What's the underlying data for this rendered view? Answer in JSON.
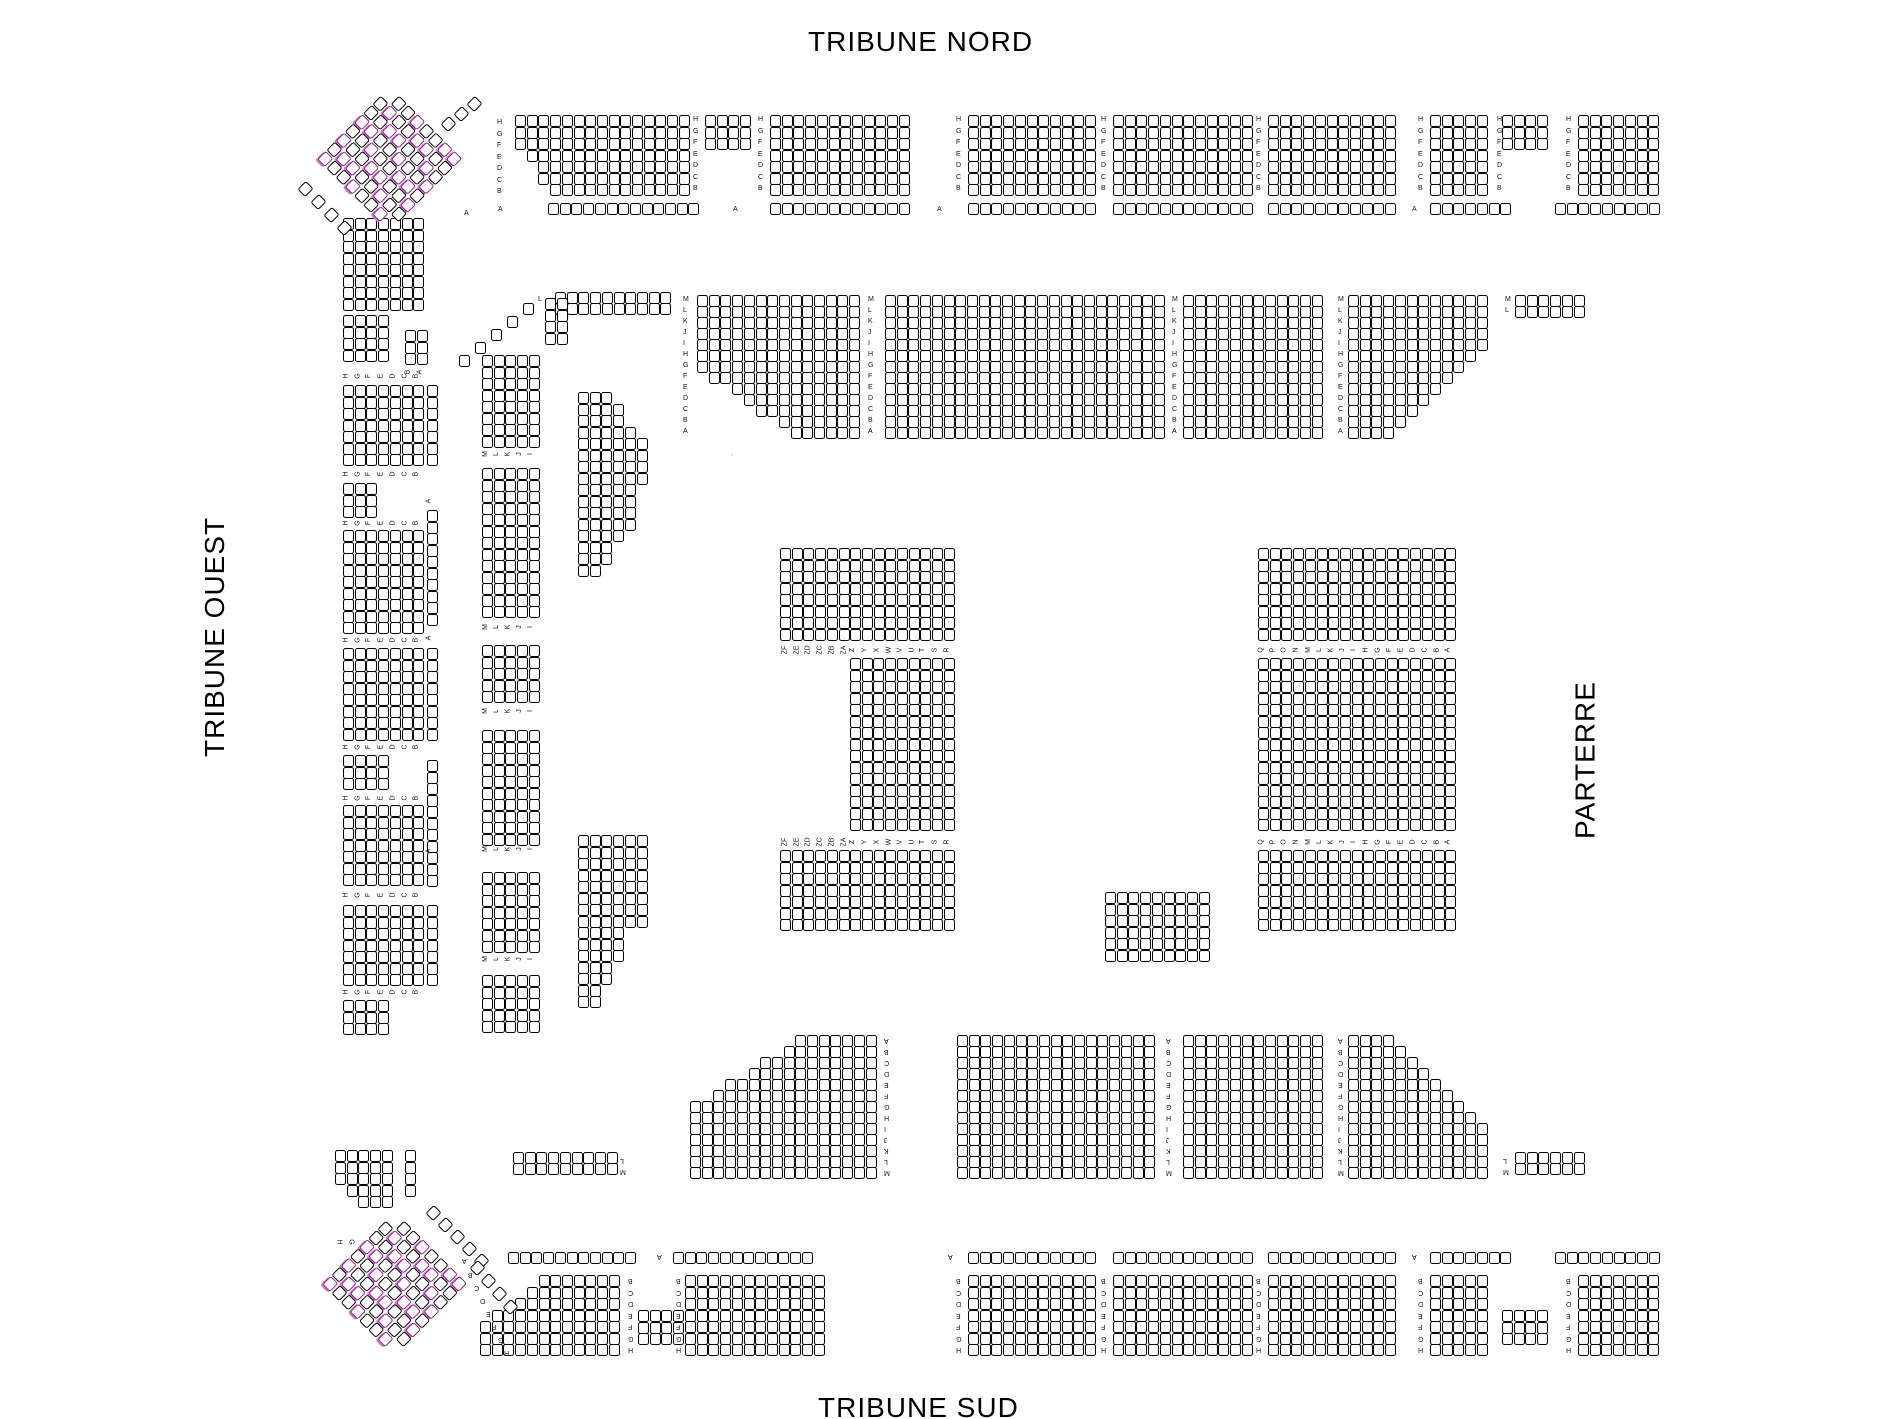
{
  "titles": {
    "north": "TRIBUNE NORD",
    "south": "TRIBUNE SUD",
    "west": "TRIBUNE OUEST",
    "parterre": "PARTERRE"
  },
  "colors": {
    "seat_fill": "#ffffff",
    "seat_border": "#000000",
    "seat_selected": "#8f1f8f",
    "label_text": "#111111"
  },
  "label_sets": {
    "HB": [
      "H",
      "G",
      "F",
      "E",
      "D",
      "C",
      "B"
    ],
    "BH": [
      "B",
      "C",
      "D",
      "E",
      "F",
      "G",
      "H"
    ],
    "MA": [
      "M",
      "L",
      "K",
      "J",
      "I",
      "H",
      "G",
      "F",
      "E",
      "D",
      "C",
      "B",
      "A"
    ],
    "AM": [
      "A",
      "B",
      "C",
      "D",
      "E",
      "F",
      "G",
      "H",
      "I",
      "J",
      "K",
      "L",
      "M"
    ],
    "ML": [
      "M",
      "L"
    ],
    "LM": [
      "L",
      "M"
    ],
    "PL": [
      "ZF",
      "ZE",
      "ZD",
      "ZC",
      "ZB",
      "ZA",
      "Z",
      "Y",
      "X",
      "W",
      "V",
      "U",
      "T",
      "S",
      "R"
    ],
    "PR": [
      "Q",
      "P",
      "O",
      "N",
      "M",
      "L",
      "K",
      "J",
      "I",
      "H",
      "G",
      "F",
      "E",
      "D",
      "C",
      "B",
      "A"
    ],
    "WO": [
      "H",
      "G",
      "F",
      "E",
      "D",
      "C",
      "B"
    ],
    "WI": [
      "M",
      "L",
      "K",
      "J",
      "I"
    ],
    "BA": [
      "B",
      "A"
    ],
    "HG": [
      "H",
      "G"
    ]
  },
  "blocks": [
    {
      "x": 515,
      "y": 115,
      "c": 15,
      "r": 7,
      "cut": "bl:3x4"
    },
    {
      "x": 705,
      "y": 115,
      "c": 4,
      "r": 3
    },
    {
      "x": 770,
      "y": 115,
      "c": 12,
      "r": 7
    },
    {
      "x": 968,
      "y": 115,
      "c": 11,
      "r": 7
    },
    {
      "x": 1113,
      "y": 115,
      "c": 12,
      "r": 7
    },
    {
      "x": 1268,
      "y": 115,
      "c": 11,
      "r": 7
    },
    {
      "x": 1430,
      "y": 115,
      "c": 5,
      "r": 7
    },
    {
      "x": 1502,
      "y": 115,
      "c": 4,
      "r": 3
    },
    {
      "x": 1578,
      "y": 115,
      "c": 7,
      "r": 7
    },
    {
      "x": 548,
      "y": 203,
      "c": 13,
      "r": 1
    },
    {
      "x": 770,
      "y": 203,
      "c": 12,
      "r": 1
    },
    {
      "x": 968,
      "y": 203,
      "c": 11,
      "r": 1
    },
    {
      "x": 1113,
      "y": 203,
      "c": 12,
      "r": 1
    },
    {
      "x": 1268,
      "y": 203,
      "c": 11,
      "r": 1
    },
    {
      "x": 1430,
      "y": 203,
      "c": 7,
      "r": 1
    },
    {
      "x": 1555,
      "y": 203,
      "c": 9,
      "r": 1
    },
    {
      "x": 555,
      "y": 292,
      "c": 10,
      "r": 2,
      "py": 11
    },
    {
      "x": 697,
      "y": 295,
      "c": 14,
      "r": 13,
      "py": 11,
      "cut": "bl:8x6"
    },
    {
      "x": 885,
      "y": 295,
      "c": 24,
      "r": 13,
      "py": 11
    },
    {
      "x": 1183,
      "y": 295,
      "c": 12,
      "r": 13,
      "py": 11
    },
    {
      "x": 1348,
      "y": 295,
      "c": 12,
      "r": 13,
      "py": 11,
      "cut": "br:8x8"
    },
    {
      "x": 1515,
      "y": 295,
      "c": 6,
      "r": 2,
      "py": 11
    },
    {
      "x": 545,
      "y": 298,
      "c": 2,
      "r": 4
    },
    {
      "x": 578,
      "y": 392,
      "c": 6,
      "r": 8,
      "cut": "tr:3x4"
    },
    {
      "x": 578,
      "y": 484,
      "c": 5,
      "r": 8,
      "cut": "br:3x4"
    },
    {
      "x": 578,
      "y": 835,
      "c": 6,
      "r": 8
    },
    {
      "x": 578,
      "y": 927,
      "c": 4,
      "r": 7,
      "cut": "br:2x5"
    },
    {
      "x": 780,
      "y": 548,
      "c": 15,
      "r": 8
    },
    {
      "x": 850,
      "y": 658,
      "c": 9,
      "r": 15
    },
    {
      "x": 780,
      "y": 850,
      "c": 15,
      "r": 7
    },
    {
      "x": 1258,
      "y": 548,
      "c": 17,
      "r": 8
    },
    {
      "x": 1258,
      "y": 658,
      "c": 17,
      "r": 15
    },
    {
      "x": 1258,
      "y": 850,
      "c": 17,
      "r": 7
    },
    {
      "x": 1105,
      "y": 892,
      "c": 9,
      "r": 6
    },
    {
      "x": 690,
      "y": 1035,
      "c": 16,
      "r": 13,
      "py": 11,
      "cut": "tl:9x6"
    },
    {
      "x": 957,
      "y": 1035,
      "c": 17,
      "r": 13,
      "py": 11
    },
    {
      "x": 1183,
      "y": 1035,
      "c": 12,
      "r": 13,
      "py": 11
    },
    {
      "x": 1348,
      "y": 1035,
      "c": 12,
      "r": 13,
      "py": 11,
      "cut": "tr:8x8"
    },
    {
      "x": 513,
      "y": 1152,
      "c": 9,
      "r": 2,
      "py": 11
    },
    {
      "x": 1515,
      "y": 1152,
      "c": 6,
      "r": 2,
      "py": 11
    },
    {
      "x": 508,
      "y": 1252,
      "c": 11,
      "r": 1
    },
    {
      "x": 673,
      "y": 1252,
      "c": 12,
      "r": 1
    },
    {
      "x": 968,
      "y": 1252,
      "c": 11,
      "r": 1
    },
    {
      "x": 1113,
      "y": 1252,
      "c": 12,
      "r": 1
    },
    {
      "x": 1268,
      "y": 1252,
      "c": 11,
      "r": 1
    },
    {
      "x": 1430,
      "y": 1252,
      "c": 7,
      "r": 1
    },
    {
      "x": 1555,
      "y": 1252,
      "c": 9,
      "r": 1
    },
    {
      "x": 480,
      "y": 1275,
      "c": 12,
      "r": 7,
      "cut": "tl:5x4"
    },
    {
      "x": 638,
      "y": 1310,
      "c": 4,
      "r": 3
    },
    {
      "x": 685,
      "y": 1275,
      "c": 12,
      "r": 7
    },
    {
      "x": 968,
      "y": 1275,
      "c": 11,
      "r": 7
    },
    {
      "x": 1113,
      "y": 1275,
      "c": 12,
      "r": 7
    },
    {
      "x": 1268,
      "y": 1275,
      "c": 11,
      "r": 7
    },
    {
      "x": 1430,
      "y": 1275,
      "c": 5,
      "r": 7
    },
    {
      "x": 1502,
      "y": 1310,
      "c": 4,
      "r": 3
    },
    {
      "x": 1578,
      "y": 1275,
      "c": 7,
      "r": 7
    },
    {
      "x": 343,
      "y": 218,
      "c": 7,
      "r": 8
    },
    {
      "x": 343,
      "y": 315,
      "c": 4,
      "r": 4
    },
    {
      "x": 343,
      "y": 385,
      "c": 7,
      "r": 7
    },
    {
      "x": 343,
      "y": 483,
      "c": 3,
      "r": 3
    },
    {
      "x": 343,
      "y": 530,
      "c": 7,
      "r": 9
    },
    {
      "x": 343,
      "y": 648,
      "c": 7,
      "r": 8
    },
    {
      "x": 343,
      "y": 755,
      "c": 4,
      "r": 3
    },
    {
      "x": 343,
      "y": 805,
      "c": 7,
      "r": 7
    },
    {
      "x": 343,
      "y": 905,
      "c": 7,
      "r": 7
    },
    {
      "x": 343,
      "y": 1000,
      "c": 4,
      "r": 3
    },
    {
      "x": 335,
      "y": 1150,
      "c": 5,
      "r": 5,
      "cut": "bl:2x2"
    },
    {
      "x": 405,
      "y": 330,
      "c": 2,
      "r": 3
    },
    {
      "x": 405,
      "y": 1150,
      "c": 1,
      "r": 4
    },
    {
      "x": 427,
      "y": 385,
      "c": 1,
      "r": 7
    },
    {
      "x": 427,
      "y": 510,
      "c": 1,
      "r": 10
    },
    {
      "x": 427,
      "y": 648,
      "c": 1,
      "r": 8
    },
    {
      "x": 427,
      "y": 760,
      "c": 1,
      "r": 11
    },
    {
      "x": 427,
      "y": 905,
      "c": 1,
      "r": 7
    },
    {
      "x": 482,
      "y": 355,
      "c": 5,
      "r": 8
    },
    {
      "x": 482,
      "y": 468,
      "c": 5,
      "r": 13
    },
    {
      "x": 482,
      "y": 645,
      "c": 5,
      "r": 5
    },
    {
      "x": 482,
      "y": 730,
      "c": 5,
      "r": 10
    },
    {
      "x": 482,
      "y": 872,
      "c": 5,
      "r": 7
    },
    {
      "x": 482,
      "y": 975,
      "c": 5,
      "r": 5
    }
  ],
  "corners": [
    {
      "cx": 390,
      "cy": 160,
      "rows": 8,
      "cols": 8
    },
    {
      "cx": 395,
      "cy": 1285,
      "rows": 8,
      "cols": 8
    }
  ],
  "runs": [
    {
      "x": 523,
      "y": 303,
      "n": 5,
      "dx": -16,
      "dy": 13,
      "d": false
    },
    {
      "x": 300,
      "y": 183,
      "n": 4,
      "dx": 13,
      "dy": 13,
      "d": true
    },
    {
      "x": 443,
      "y": 118,
      "n": 3,
      "dx": 13,
      "dy": -10,
      "d": true
    },
    {
      "x": 428,
      "y": 1207,
      "n": 5,
      "dx": 12,
      "dy": 12,
      "d": true
    },
    {
      "x": 472,
      "y": 1262,
      "n": 4,
      "dx": 11,
      "dy": 13,
      "d": true
    }
  ],
  "label_columns": [
    {
      "x": 497,
      "y": 118,
      "set": "HB",
      "step": 11.5
    },
    {
      "x": 693,
      "y": 115,
      "set": "HB",
      "step": 11.5
    },
    {
      "x": 758,
      "y": 115,
      "set": "HB",
      "step": 11.5
    },
    {
      "x": 956,
      "y": 115,
      "set": "HB",
      "step": 11.5
    },
    {
      "x": 1101,
      "y": 115,
      "set": "HB",
      "step": 11.5
    },
    {
      "x": 1256,
      "y": 115,
      "set": "HB",
      "step": 11.5
    },
    {
      "x": 1418,
      "y": 115,
      "set": "HB",
      "step": 11.5
    },
    {
      "x": 1497,
      "y": 115,
      "set": "HB",
      "step": 11.5
    },
    {
      "x": 1566,
      "y": 115,
      "set": "HB",
      "step": 11.5
    },
    {
      "x": 683,
      "y": 295,
      "set": "MA",
      "step": 11
    },
    {
      "x": 868,
      "y": 295,
      "set": "MA",
      "step": 11
    },
    {
      "x": 1172,
      "y": 295,
      "set": "MA",
      "step": 11
    },
    {
      "x": 1338,
      "y": 295,
      "set": "MA",
      "step": 11
    },
    {
      "x": 1505,
      "y": 295,
      "set": "ML",
      "step": 11
    },
    {
      "x": 884,
      "y": 1035,
      "set": "AM",
      "step": 11,
      "flip": true
    },
    {
      "x": 1166,
      "y": 1035,
      "set": "AM",
      "step": 11,
      "flip": true
    },
    {
      "x": 1338,
      "y": 1035,
      "set": "AM",
      "step": 11,
      "flip": true
    },
    {
      "x": 620,
      "y": 1155,
      "set": "LM",
      "step": 11,
      "flip": true
    },
    {
      "x": 1503,
      "y": 1155,
      "set": "LM",
      "step": 11,
      "flip": true
    },
    {
      "x": 628,
      "y": 1275,
      "set": "BH",
      "step": 11.5,
      "flip": true
    },
    {
      "x": 676,
      "y": 1275,
      "set": "BH",
      "step": 11.5,
      "flip": true
    },
    {
      "x": 956,
      "y": 1275,
      "set": "BH",
      "step": 11.5,
      "flip": true
    },
    {
      "x": 1101,
      "y": 1275,
      "set": "BH",
      "step": 11.5,
      "flip": true
    },
    {
      "x": 1256,
      "y": 1275,
      "set": "BH",
      "step": 11.5,
      "flip": true
    },
    {
      "x": 1418,
      "y": 1275,
      "set": "BH",
      "step": 11.5,
      "flip": true
    },
    {
      "x": 1566,
      "y": 1275,
      "set": "BH",
      "step": 11.5,
      "flip": true
    }
  ],
  "label_rows": [
    {
      "x": 780,
      "y": 646,
      "set": "PL",
      "step": 11.7,
      "rot": -90
    },
    {
      "x": 780,
      "y": 838,
      "set": "PL",
      "step": 11.7,
      "rot": -90
    },
    {
      "x": 1258,
      "y": 646,
      "set": "PR",
      "step": 11.7,
      "rot": -90
    },
    {
      "x": 1258,
      "y": 838,
      "set": "PR",
      "step": 11.7,
      "rot": -90
    },
    {
      "x": 343,
      "y": 372,
      "set": "WO",
      "step": 11.7,
      "rot": -90
    },
    {
      "x": 343,
      "y": 470,
      "set": "WO",
      "step": 11.7,
      "rot": -90
    },
    {
      "x": 343,
      "y": 519,
      "set": "WO",
      "step": 11.7,
      "rot": -90
    },
    {
      "x": 343,
      "y": 636,
      "set": "WO",
      "step": 11.7,
      "rot": -90
    },
    {
      "x": 343,
      "y": 743,
      "set": "WO",
      "step": 11.7,
      "rot": -90
    },
    {
      "x": 343,
      "y": 794,
      "set": "WO",
      "step": 11.7,
      "rot": -90
    },
    {
      "x": 343,
      "y": 891,
      "set": "WO",
      "step": 11.7,
      "rot": -90
    },
    {
      "x": 343,
      "y": 988,
      "set": "WO",
      "step": 11.7,
      "rot": -90
    },
    {
      "x": 335,
      "y": 1238,
      "set": "HG",
      "step": 11.7,
      "rot": 90
    },
    {
      "x": 405,
      "y": 368,
      "set": "BA",
      "step": 12,
      "rot": -90
    },
    {
      "x": 482,
      "y": 450,
      "set": "WI",
      "step": 11.7,
      "rot": -90
    },
    {
      "x": 482,
      "y": 623,
      "set": "WI",
      "step": 11.7,
      "rot": -90
    },
    {
      "x": 482,
      "y": 707,
      "set": "WI",
      "step": 11.7,
      "rot": -90
    },
    {
      "x": 482,
      "y": 845,
      "set": "WI",
      "step": 11.7,
      "rot": -90
    },
    {
      "x": 482,
      "y": 955,
      "set": "WI",
      "step": 11.7,
      "rot": -90
    }
  ],
  "labels": [
    {
      "x": 498,
      "y": 206,
      "s": "A"
    },
    {
      "x": 733,
      "y": 206,
      "s": "A"
    },
    {
      "x": 937,
      "y": 206,
      "s": "A"
    },
    {
      "x": 1412,
      "y": 206,
      "s": "A"
    },
    {
      "x": 538,
      "y": 296,
      "s": "L"
    },
    {
      "x": 464,
      "y": 210,
      "s": "A"
    },
    {
      "x": 657,
      "y": 1252,
      "s": "A",
      "flip": true
    },
    {
      "x": 948,
      "y": 1252,
      "s": "A",
      "flip": true
    },
    {
      "x": 1412,
      "y": 1252,
      "s": "A",
      "flip": true
    },
    {
      "x": 462,
      "y": 1256,
      "s": "A",
      "flip": true
    },
    {
      "x": 468,
      "y": 1270,
      "s": "B",
      "flip": true
    },
    {
      "x": 474,
      "y": 1283,
      "s": "C",
      "flip": true
    },
    {
      "x": 480,
      "y": 1296,
      "s": "D",
      "flip": true
    },
    {
      "x": 486,
      "y": 1309,
      "s": "E",
      "flip": true
    },
    {
      "x": 492,
      "y": 1322,
      "s": "F",
      "flip": true
    },
    {
      "x": 498,
      "y": 1335,
      "s": "G",
      "flip": true
    },
    {
      "x": 504,
      "y": 1348,
      "s": "H",
      "flip": true
    },
    {
      "x": 427,
      "y": 497,
      "s": "A",
      "rot": -90
    },
    {
      "x": 427,
      "y": 634,
      "s": "A",
      "rot": -90
    },
    {
      "x": 427,
      "y": 847,
      "s": "A",
      "rot": -90
    },
    {
      "x": 731,
      "y": 455,
      "s": "`"
    }
  ]
}
